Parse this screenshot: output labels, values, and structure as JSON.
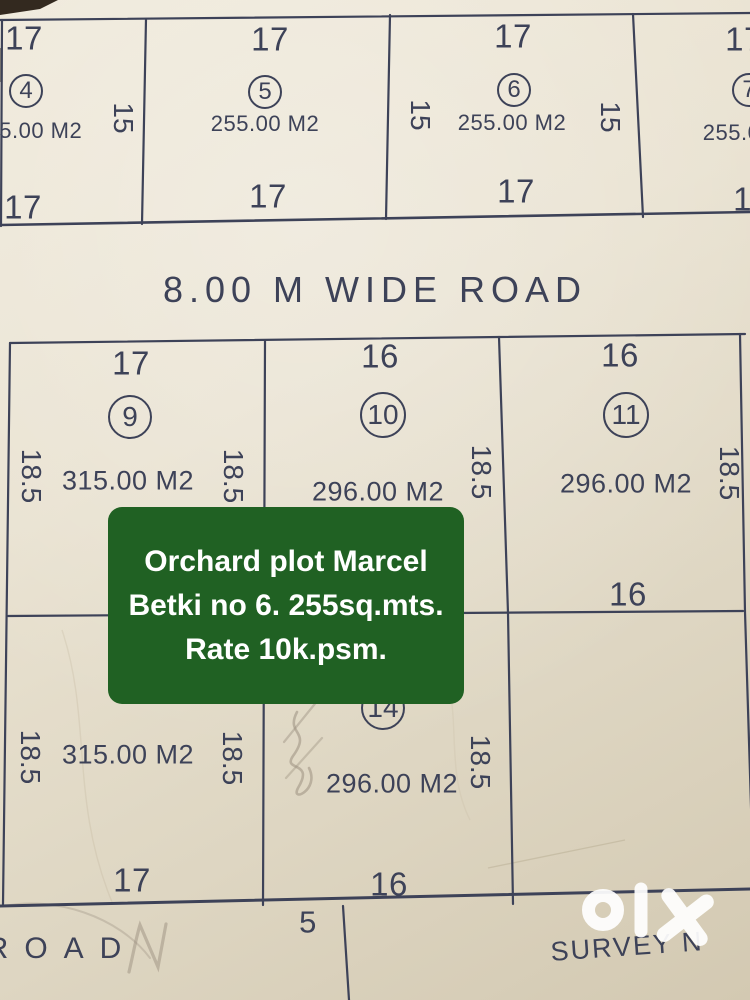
{
  "colors": {
    "ink": "#3d4258",
    "paper": "#e7e0cf",
    "overlay_green": "#206123",
    "pencil": "#9b9080",
    "watermark_white": "#ffffff"
  },
  "top_row": {
    "p4": {
      "top_dim": "17",
      "number": "4",
      "area": "255.00 M2",
      "bottom_dim": "17"
    },
    "p5": {
      "top_dim": "17",
      "number": "5",
      "area": "255.00 M2",
      "bottom_dim": "17"
    },
    "p6": {
      "top_dim": "17",
      "number": "6",
      "area": "255.00 M2",
      "bottom_dim": "17",
      "left_dim": "15",
      "right_dim": "15"
    },
    "p7": {
      "top_dim": "17",
      "number": "7",
      "area": "255.00 M2",
      "bottom_dim": "17"
    },
    "divider_dim_4_5": "15"
  },
  "road_strip": {
    "label": "8.00 M WIDE ROAD"
  },
  "grid": {
    "p9": {
      "top_dim": "17",
      "number": "9",
      "area": "315.00 M2",
      "left_dim": "18.5",
      "right_dim": "18.5"
    },
    "p10": {
      "top_dim": "16",
      "number": "10",
      "area": "296.00 M2",
      "right_dim": "18.5"
    },
    "p11": {
      "top_dim": "16",
      "number": "11",
      "area": "296.00 M2",
      "right_dim": "18.5",
      "bottom_dim": "16"
    },
    "p12": {
      "area": "315.00 M2",
      "left_dim": "18.5",
      "right_dim": "18.5",
      "bottom_dim": "17"
    },
    "p14": {
      "number": "14",
      "area": "296.00 M2",
      "right_dim": "18.5",
      "bottom_dim": "16",
      "below_dim": "5"
    }
  },
  "bottom_strip": {
    "road_label": "ROAD",
    "survey_label": "SURVEY N"
  },
  "overlay_card": {
    "lines": [
      "Orchard plot Marcel",
      "Betki no 6. 255sq.mts.",
      "Rate 10k.psm."
    ]
  },
  "watermark": {
    "text": "olx"
  }
}
